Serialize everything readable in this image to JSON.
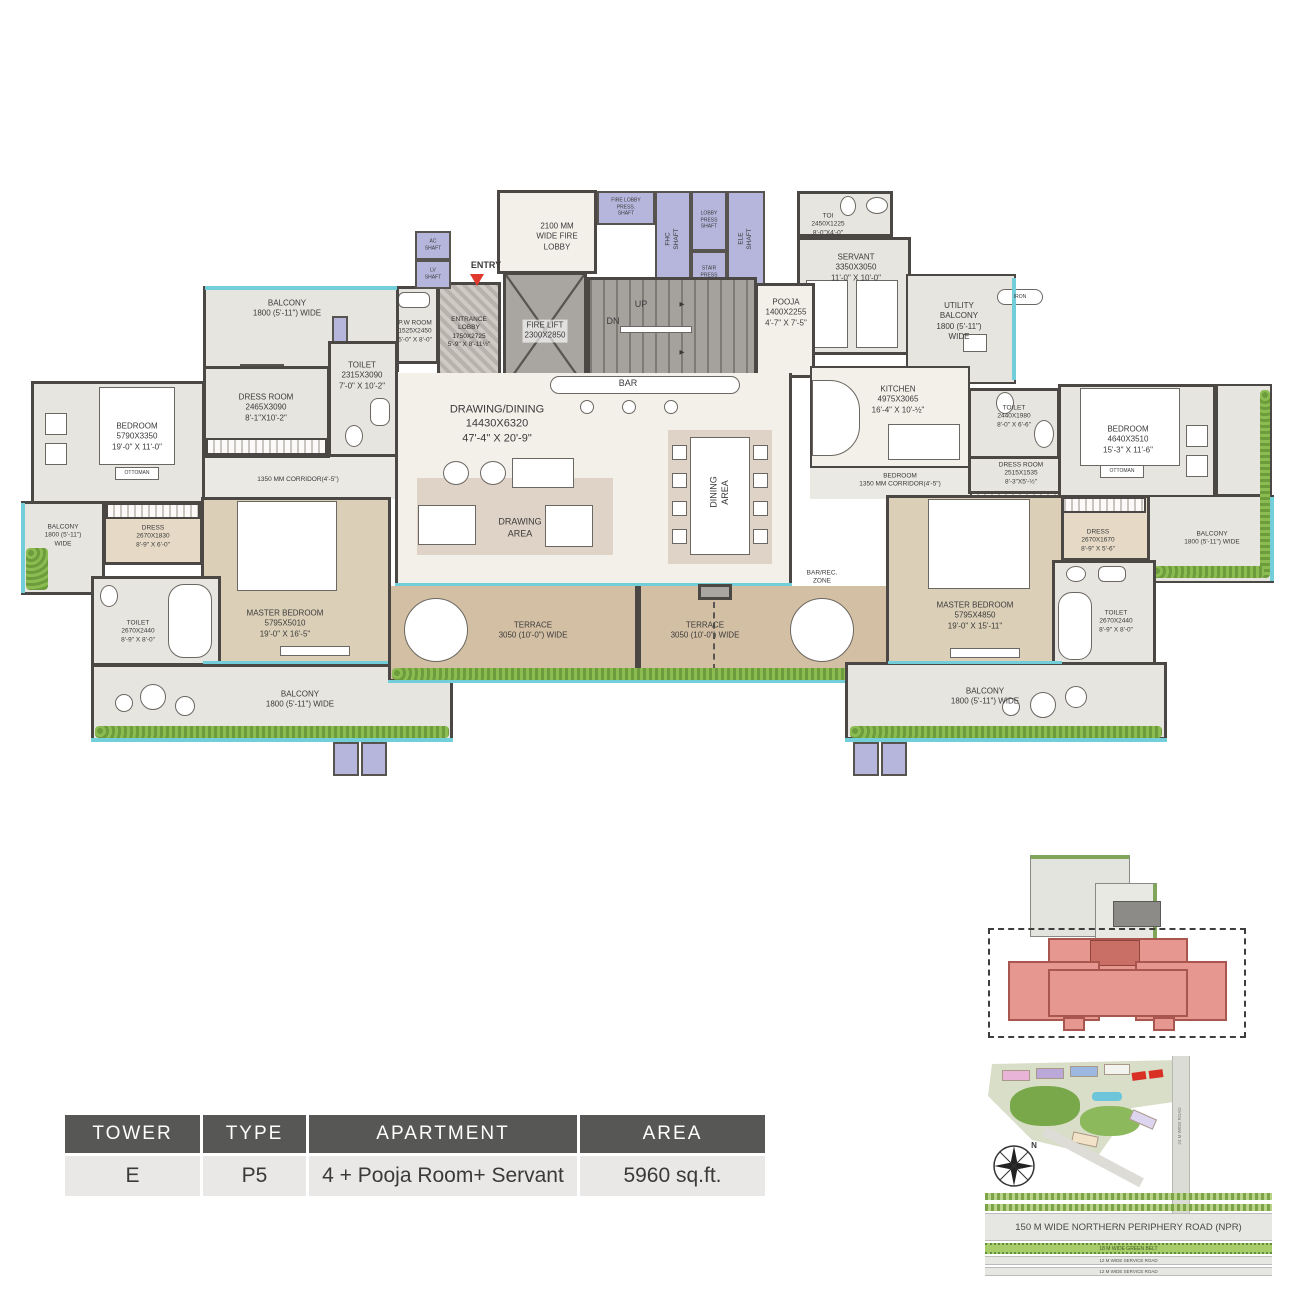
{
  "title_block": {
    "headers": [
      "TOWER",
      "TYPE",
      "APARTMENT",
      "AREA"
    ],
    "values": [
      "E",
      "P5",
      "4 + Pooja Room+ Servant",
      "5960 sq.ft."
    ]
  },
  "plan": {
    "entry_label": "ENTRY",
    "rooms": {
      "fire_lobby": "2100 MM\nWIDE FIRE\nLOBBY",
      "fire_lobby_press_shaft": "FIRE LOBBY\nPRESS.\nSHAFT",
      "fhc_shaft": "FHC\nSHAFT",
      "lobby_press_shaft": "LOBBY\nPRESS\nSHAFT",
      "stair_press": "STAIR\nPRESS",
      "ele_shaft": "ELE\nSHAFT",
      "ac_shaft": "AC\nSHAFT",
      "lv_shaft": "LV\nSHAFT",
      "fire_lift": "FIRE LIFT\n2300X2850",
      "up": "UP",
      "dn": "DN",
      "stair_arrow": "▶",
      "toi_top": "TOI\n2450X1225\n8'-0\"X4'-0\"",
      "servant": "SERVANT\n3350X3050\n11'-0\" X 10'-0\"",
      "pooja": "POOJA\n1400X2255\n4'-7\" X 7'-5\"",
      "utility_balcony": "UTILITY\nBALCONY\n1800 (5'-11\")\nWIDE",
      "iron": "IRON",
      "pw_room": "P.W ROOM\n1525X2450\n5'-0\" X 8'-0\"",
      "entrance_lobby": "ENTRANCE\nLOBBY\n1750X2725\n5'-9\" X 8'-11½\"",
      "balcony_top_left": "BALCONY\n1800 (5'-11\") WIDE",
      "toilet_upper_left": "TOILET\n2315X3090\n7'-0\" X 10'-2\"",
      "dress_room_left": "DRESS ROOM\n2465X3090\n8'-1\"X10'-2\"",
      "bedroom_left": "BEDROOM\n5790X3350\n19'-0\" X 11'-0\"",
      "ottoman_left": "OTTOMAN",
      "corridor_left": "1350 MM CORRIDOR(4'-5\")",
      "balcony_far_left": "BALCONY\n1800 (5'-11\")\nWIDE",
      "dress_left": "DRESS\n2670X1830\n8'-9\" X 6'-0\"",
      "toilet_lower_left": "TOILET\n2670X2440\n8'-9\" X 8'-0\"",
      "master_bedroom_left": "MASTER BEDROOM\n5795X5010\n19'-0\" X 16'-5\"",
      "balcony_bottom_left": "BALCONY\n1800 (5'-11\") WIDE",
      "drawing_dining": "DRAWING/DINING\n14430X6320\n47'-4\" X 20'-9\"",
      "bar": "BAR",
      "drawing_area": "DRAWING\nAREA",
      "dining_area": "DINING\nAREA",
      "terrace_left": "TERRACE\n3050 (10'-0\") WIDE",
      "terrace_right": "TERRACE\n3050 (10'-0\") WIDE",
      "bar_rec_zone": "BAR/REC.\nZONE",
      "kitchen": "KITCHEN\n4975X3065\n16'-4\" X 10'-½\"",
      "corridor_right": "BEDROOM\n1350 MM CORRIDOR(4'-5\")",
      "toilet_right_upper": "TOILET\n2440X1980\n8'-0\" X 6'-6\"",
      "dress_room_right": "DRESS ROOM\n2515X1535\n8'-3\"X5'-½\"",
      "bedroom_right": "BEDROOM\n4640X3510\n15'-3\" X 11'-6\"",
      "ottoman_right": "OTTOMAN",
      "balcony_right": "BALCONY\n1800 (5'-11\") WIDE",
      "dress_right": "DRESS\n2670X1670\n8'-9\" X 5'-6\"",
      "master_bedroom_right": "MASTER BEDROOM\n5795X4850\n19'-0\" X 15'-11\"",
      "toilet_right_lower": "TOILET\n2670X2440\n8'-9\" X 8'-0\"",
      "balcony_bottom_right": "BALCONY\n1800 (5'-11\") WIDE"
    }
  },
  "site_map": {
    "compass_north": "N",
    "road_vertical": "24 M WIDE ROAD",
    "npr_road": "150 M  WIDE NORTHERN PERIPHERY ROAD (NPR)",
    "green_belt": "18 M WIDE GREEN BELT",
    "service_road_1": "12 M WIDE SERVICE ROAD",
    "service_road_2": "12 M WIDE SERVICE ROAD"
  },
  "colors": {
    "wall": "#4b4744",
    "shaft": "#b6b5dc",
    "glass": "#72ced9",
    "terrace": "#d3bfa3",
    "highlight_unit": "#e59790",
    "table_header": "#575756"
  }
}
